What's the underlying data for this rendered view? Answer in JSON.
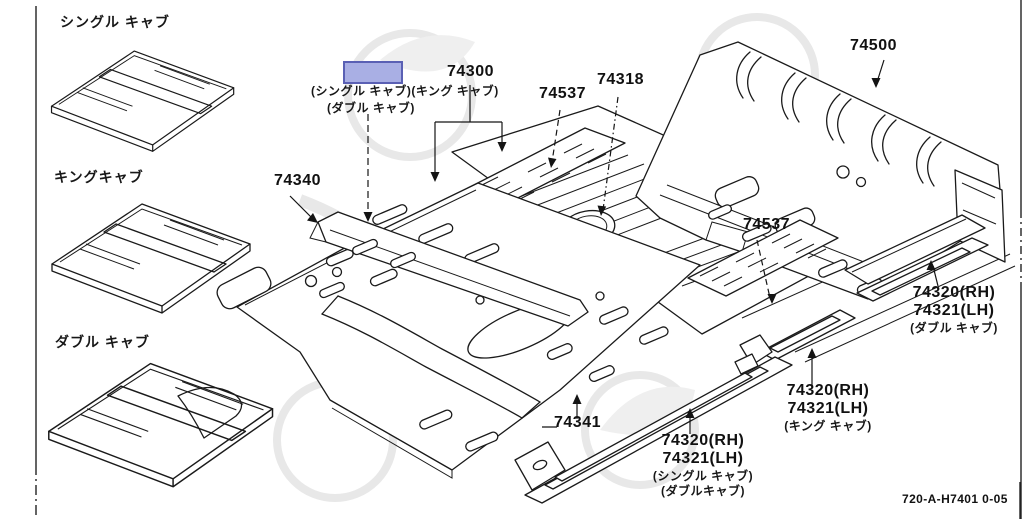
{
  "colors": {
    "line": "#1a1a1a",
    "highlight_fill": "#a9afe4",
    "highlight_border": "#5a60b4",
    "watermark": "#e8e8e8"
  },
  "variants": {
    "single": "シングル キャブ",
    "king": "キングキャブ",
    "double": "ダブル キャブ"
  },
  "callouts": {
    "c74300": {
      "part": "74300",
      "note_line1": "(シングル キャブ)(キング キャブ)",
      "note_line2": "(ダブル キャブ)"
    },
    "c74340": {
      "part": "74340"
    },
    "c74537a": {
      "part": "74537"
    },
    "c74318": {
      "part": "74318"
    },
    "c74500": {
      "part": "74500"
    },
    "c74537b": {
      "part": "74537"
    },
    "c74341": {
      "part": "74341"
    },
    "sill_right": {
      "line1": "74320(RH)",
      "line2": "74321(LH)",
      "note": "(ダブル キャブ)"
    },
    "sill_mid": {
      "line1": "74320(RH)",
      "line2": "74321(LH)",
      "note": "(キング キャブ)"
    },
    "sill_bottom": {
      "line1": "74320(RH)",
      "line2": "74321(LH)",
      "note1": "(シングル キャブ)",
      "note2": "(ダブルキャブ)"
    }
  },
  "page": {
    "doc_code": "720-A-H7401 0-05"
  }
}
